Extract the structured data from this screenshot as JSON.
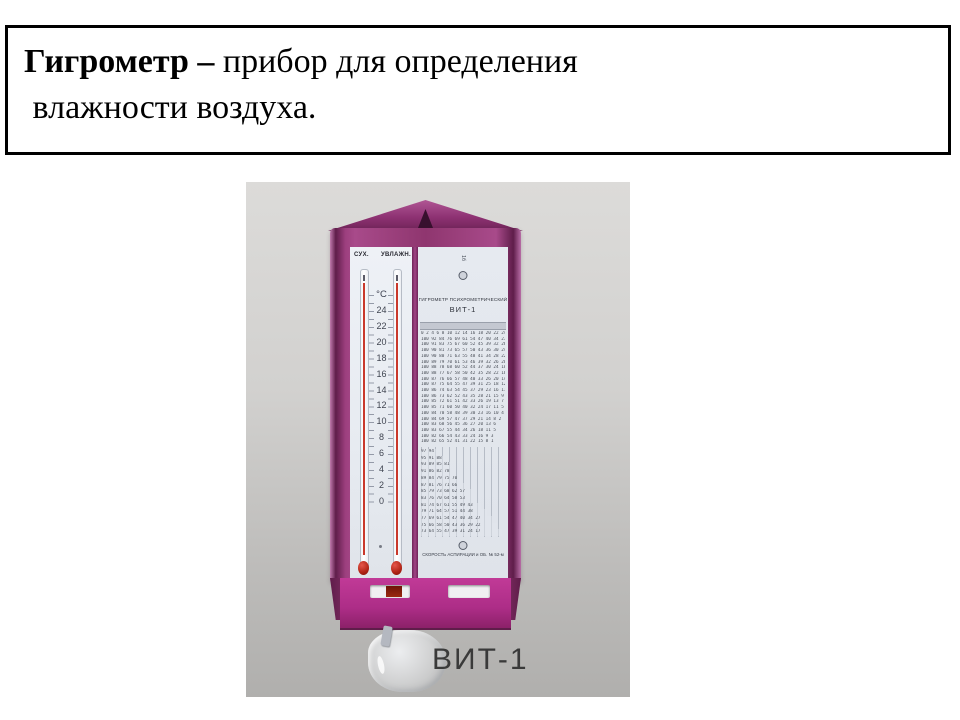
{
  "definition": {
    "term_bold": "Гигрометр – ",
    "line1_rest": "прибор для определения",
    "line2": " влажности воздуха."
  },
  "photo": {
    "caption": "ВИТ-1",
    "device": {
      "left_thermometer_label": "СУХ.",
      "right_thermometer_label": "УВЛАЖН.",
      "scale_unit": "°С",
      "scale_numbers": [
        "24",
        "22",
        "20",
        "18",
        "16",
        "14",
        "12",
        "10",
        "8",
        "6",
        "4",
        "2",
        "0"
      ],
      "top_mark": "1б",
      "label_title_line1": "ГИГРОМЕТР ПСИХРОМЕТРИЧЕСКИЙ",
      "label_title_line2": "ВИТ-1",
      "bottom_note": "СКОРОСТЬ АСПИРАЦИИ и ОБ. № 52-м",
      "table_rows": [
        "0 2 4 6 8 10 12 14 16 18 20 22 24",
        "100 92 84 76 69 61 54 47 40 34 27 21",
        "100 91 83 75 67 60 52 45 39 32 26 20",
        "100 90 81 73 65 57 50 43 36 30 24 18",
        "100 90 80 71 63 55 48 41 34 28 22 16",
        "100 89 79 70 61 53 46 39 32 26 20 14",
        "100 88 78 68 60 52 44 37 30 24 18 12",
        "100 88 77 67 58 50 42 35 28 22 16 10",
        "100 87 76 66 57 48 40 33 26 20 14 9",
        "100 87 75 64 55 47 39 31 25 18 12 7",
        "100 86 74 63 54 45 37 29 23 16 11 5",
        "100 86 73 62 52 43 35 28 21 15 9 4",
        "100 85 72 61 51 42 33 26 19 13 7 2",
        "100 85 71 60 50 40 32 24 17 11 5 0",
        "100 84 70 58 48 39 30 23 16 10 4",
        "100 84 69 57 47 37 29 21 14 8 2",
        "100 83 68 56 45 36 27 20 13 6",
        "100 83 67 55 44 34 26 18 11 5",
        "100 82 66 54 43 33 24 16 9 3",
        "100 82 65 52 41 31 22 15 8 1"
      ],
      "stair_rows": [
        "97 94",
        "95 91 88",
        "93 89 85 81",
        "91 86 82 78",
        "89 84 79 75 70",
        "87 81 76 71 66",
        "85 79 73 68 62 57",
        "83 76 70 64 58 53",
        "81 74 67 61 55 49 43",
        "79 71 64 57 51 44 38",
        "77 69 61 54 47 40 34 27",
        "75 66 58 50 43 36 29 22",
        "73 64 55 47 39 31 24 17"
      ]
    }
  },
  "colors": {
    "frame_purple": "#8f366f",
    "bottom_magenta": "#ad2d87",
    "panel_bg": "#e9edf3",
    "thermometer_red": "#c9382b",
    "photo_bg_top": "#dcdbd9",
    "photo_bg_bottom": "#b0afad",
    "caption_gray": "#3a3a3a"
  }
}
